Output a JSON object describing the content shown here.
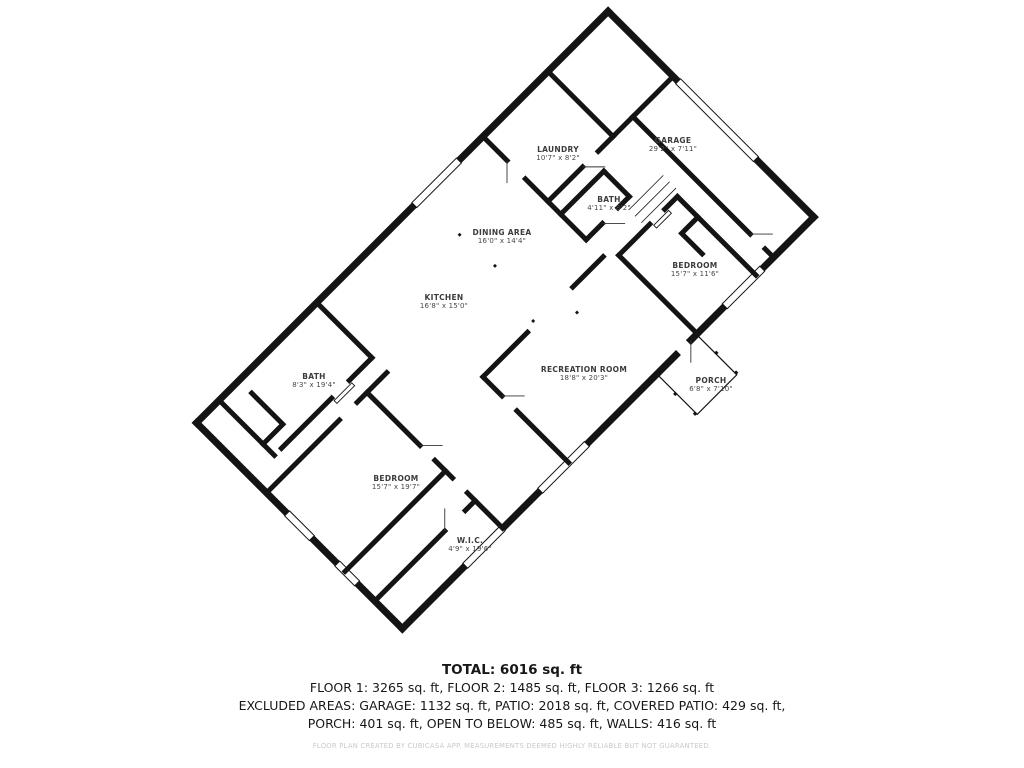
{
  "rooms": {
    "laundry": {
      "name": "LAUNDRY",
      "dims": "10'7\" x 8'2\""
    },
    "garage": {
      "name": "GARAGE",
      "dims": "29'2\" x 7'11\""
    },
    "bath_top": {
      "name": "BATH",
      "dims": "4'11\" x 8'2\""
    },
    "dining": {
      "name": "DINING AREA",
      "dims": "16'0\" x 14'4\""
    },
    "bedroom_right": {
      "name": "BEDROOM",
      "dims": "15'7\" x 11'6\""
    },
    "kitchen": {
      "name": "KITCHEN",
      "dims": "16'8\" x 15'0\""
    },
    "recreation": {
      "name": "RECREATION ROOM",
      "dims": "18'8\" x 20'3\""
    },
    "porch": {
      "name": "PORCH",
      "dims": "6'8\" x 7'10\""
    },
    "bath_left": {
      "name": "BATH",
      "dims": "8'3\" x 19'4\""
    },
    "bedroom_bottom": {
      "name": "BEDROOM",
      "dims": "15'7\" x 19'7\""
    },
    "wic": {
      "name": "W.I.C.",
      "dims": "4'9\" x 19'6\""
    }
  },
  "summary": {
    "total": "TOTAL: 6016 sq. ft",
    "floors": "FLOOR 1: 3265 sq. ft, FLOOR 2: 1485 sq. ft, FLOOR 3: 1266 sq. ft",
    "excluded1": "EXCLUDED AREAS: GARAGE: 1132 sq. ft, PATIO: 2018 sq. ft, COVERED PATIO: 429 sq. ft,",
    "excluded2": "PORCH: 401 sq. ft, OPEN TO BELOW: 485 sq. ft, WALLS: 416 sq. ft"
  },
  "disclaimer": "FLOOR PLAN CREATED BY CUBICASA APP. MEASUREMENTS DEEMED HIGHLY RELIABLE BUT NOT GUARANTEED.",
  "colors": {
    "wall": "#141414",
    "label": "#3c3c3c",
    "fine_print": "#c9c9c9"
  }
}
